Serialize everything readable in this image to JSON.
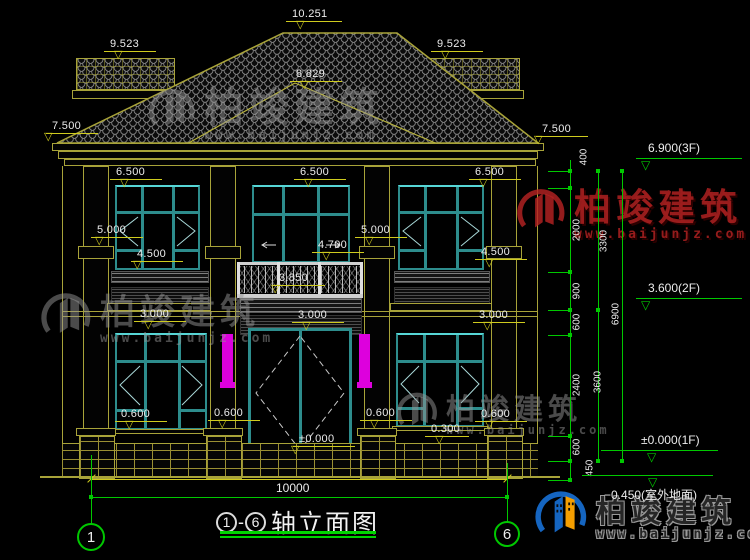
{
  "colors": {
    "cad_yellow": "#cfcb1e",
    "cad_olive": "#a8a339",
    "cad_green": "#00c800",
    "cad_teal": "#2d8c8c",
    "magenta": "#dd00dd",
    "watermark_gray": "#969696",
    "watermark_red": "#b42222",
    "logo_blue": "#1565c0",
    "logo_orange": "#f59f00",
    "text": "#ececec"
  },
  "dim_flags": [
    {
      "t": "10.251",
      "x": 292,
      "y": 8,
      "lw": 56
    },
    {
      "t": "9.523",
      "x": 110,
      "y": 38
    },
    {
      "t": "9.523",
      "x": 437,
      "y": 38
    },
    {
      "t": "8.829",
      "x": 296,
      "y": 68
    },
    {
      "t": "7.500",
      "x": 52,
      "y": 120,
      "tx": -8
    },
    {
      "t": "7.500",
      "x": 542,
      "y": 123,
      "tx": -8
    },
    {
      "t": "6.500",
      "x": 116,
      "y": 166
    },
    {
      "t": "6.500",
      "x": 300,
      "y": 166
    },
    {
      "t": "6.500",
      "x": 475,
      "y": 166
    },
    {
      "t": "5.000",
      "x": 97,
      "y": 224,
      "tx": -2
    },
    {
      "t": "5.000",
      "x": 361,
      "y": 224
    },
    {
      "t": "4.500",
      "x": 137,
      "y": 248,
      "tx": -4
    },
    {
      "t": "4.700",
      "x": 318,
      "y": 239
    },
    {
      "t": "4.500",
      "x": 481,
      "y": 246
    },
    {
      "t": "3.850",
      "x": 279,
      "y": 272,
      "tx": -8
    },
    {
      "t": "3.000",
      "x": 140,
      "y": 308
    },
    {
      "t": "3.000",
      "x": 298,
      "y": 309
    },
    {
      "t": "3.000",
      "x": 479,
      "y": 309
    },
    {
      "t": "0.600",
      "x": 121,
      "y": 408
    },
    {
      "t": "0.600",
      "x": 214,
      "y": 407
    },
    {
      "t": "0.600",
      "x": 366,
      "y": 407
    },
    {
      "t": "0.600",
      "x": 481,
      "y": 408
    },
    {
      "t": "0.300",
      "x": 431,
      "y": 423,
      "lw": 44
    },
    {
      "t": "±0.000",
      "x": 299,
      "y": 433,
      "lw": 62,
      "tx": -8
    }
  ],
  "vchain": {
    "lines": [
      {
        "x": 570,
        "y1": 160,
        "y2": 480,
        "ticks": [
          171,
          188,
          272,
          310,
          335,
          436,
          461,
          480
        ]
      },
      {
        "x": 598,
        "y1": 171,
        "y2": 461,
        "ticks": [
          171,
          310,
          461
        ]
      },
      {
        "x": 622,
        "y1": 171,
        "y2": 461,
        "ticks": [
          171,
          461
        ]
      }
    ],
    "side_ticks": {
      "x": 548,
      "w": 22,
      "ys": [
        171,
        188,
        272,
        310,
        335,
        436,
        461,
        480
      ]
    },
    "labels": [
      {
        "t": "400",
        "x": 584,
        "y": 157
      },
      {
        "t": "2000",
        "x": 577,
        "y": 230
      },
      {
        "t": "900",
        "x": 577,
        "y": 291
      },
      {
        "t": "600",
        "x": 577,
        "y": 322
      },
      {
        "t": "2400",
        "x": 577,
        "y": 385
      },
      {
        "t": "600",
        "x": 577,
        "y": 447
      },
      {
        "t": "450",
        "x": 590,
        "y": 468
      },
      {
        "t": "3300",
        "x": 604,
        "y": 241
      },
      {
        "t": "3600",
        "x": 598,
        "y": 382
      },
      {
        "t": "6900",
        "x": 616,
        "y": 314
      }
    ]
  },
  "elev_flags": [
    {
      "t": "6.900(3F)",
      "x": 648,
      "y": 141,
      "lx": 636,
      "ly": 158,
      "lw": 106,
      "trix": 641
    },
    {
      "t": "3.600(2F)",
      "x": 648,
      "y": 281,
      "lx": 636,
      "ly": 298,
      "lw": 106,
      "trix": 641
    },
    {
      "t": "±0.000(1F)",
      "x": 641,
      "y": 433,
      "lx": 601,
      "ly": 450,
      "lw": 117,
      "trix": 647
    },
    {
      "t": "−0.450(室外地面)",
      "x": 604,
      "y": 486,
      "lx": 582,
      "ly": 475,
      "lw": 131,
      "trix": 648
    }
  ],
  "bottom_dim": {
    "text": "10000",
    "x1": 91,
    "x2": 507,
    "y": 479,
    "tx": 276,
    "ty": 481
  },
  "grid": {
    "connector": {
      "y": 497,
      "x1": 91,
      "x2": 507
    },
    "vlines": [
      {
        "x": 91,
        "y1": 455,
        "y2": 524
      },
      {
        "x": 507,
        "y1": 463,
        "y2": 522
      }
    ],
    "dots": [
      [
        91,
        497
      ],
      [
        507,
        497
      ]
    ],
    "bubbles": [
      {
        "label": "1",
        "cx": 91,
        "cy": 537,
        "r": 14
      },
      {
        "label": "6",
        "cx": 507,
        "cy": 534,
        "r": 13
      }
    ]
  },
  "title_block": {
    "start_axis": "1",
    "dash": "-",
    "end_axis": "6",
    "name": "轴立面图"
  },
  "watermarks": [
    {
      "variant": "gray",
      "text": "柏竣建筑",
      "url": "www.baijunjz.com",
      "x": 146,
      "y": 86,
      "fs": 40,
      "ufs": 13,
      "ls": 52
    },
    {
      "variant": "red",
      "text": "柏竣建筑",
      "url": "www.baijunjz.com",
      "x": 514,
      "y": 186,
      "fs": 37,
      "ufs": 13,
      "ls": 54
    },
    {
      "variant": "gray",
      "text": "柏竣建筑",
      "url": "www.baijunjz.com",
      "x": 38,
      "y": 290,
      "fs": 35,
      "ufs": 13,
      "ls": 56
    },
    {
      "variant": "gray",
      "text": "柏竣建筑",
      "url": "www.baijunjz.com",
      "x": 394,
      "y": 390,
      "fs": 29,
      "ufs": 12,
      "ls": 46
    },
    {
      "variant": "color",
      "text": "柏竣建筑",
      "url": "www.baijunjz.com",
      "x": 532,
      "y": 488,
      "fs": 30,
      "ufs": 13,
      "ls": 58
    }
  ]
}
